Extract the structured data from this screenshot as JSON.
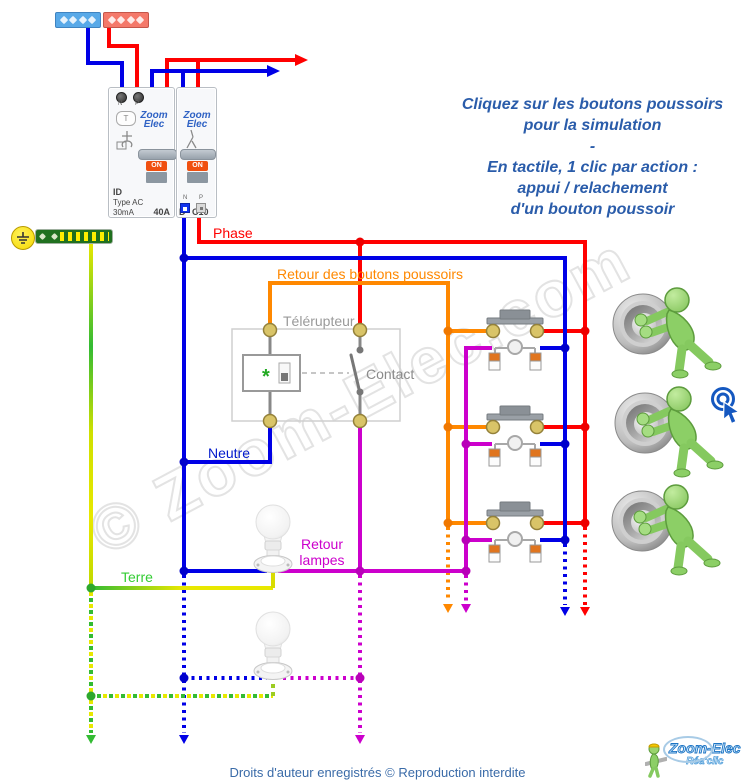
{
  "instructions": {
    "l1": "Cliquez sur les boutons poussoirs",
    "l2": "pour la simulation",
    "l3": "-",
    "l4": "En tactile, 1 clic par action :",
    "l5": "appui / relachement",
    "l6": "d'un bouton poussoir"
  },
  "labels": {
    "phase": "Phase",
    "retour_boutons": "Retour des boutons poussoirs",
    "telerupteur": "Télérupteur",
    "contact": "Contact",
    "neutre": "Neutre",
    "retour_lampes_l1": "Retour",
    "retour_lampes_l2": "lampes",
    "terre": "Terre",
    "coil_mark": "*"
  },
  "modules": {
    "differential": {
      "terminal_n": "N",
      "terminal_p": "P",
      "test_button": "T",
      "brand_l1": "Zoom",
      "brand_l2": "Elec",
      "on_label": "ON",
      "id_label": "ID",
      "type_label": "Type AC",
      "sensitivity": "30mA",
      "rating": "40A"
    },
    "breaker": {
      "brand_l1": "Zoom",
      "brand_l2": "Elec",
      "on_label": "ON",
      "curve": "D",
      "rating": "C10",
      "terminal_n": "N",
      "terminal_p": "P"
    }
  },
  "watermark": {
    "text": "© Zoom-Elec.com"
  },
  "footer": {
    "copyright": "Droits d'auteur enregistrés © Reproduction interdite"
  },
  "logo": {
    "name": "Zoom-Elec",
    "tagline": "Réa'clic"
  },
  "colors": {
    "phase": "#ff0000",
    "neutre": "#0000e6",
    "retour_boutons": "#ff8800",
    "retour_lampes": "#cc00cc",
    "terre_green": "#33cc33",
    "terre_yellow": "#e8e800",
    "instruction_blue": "#2a5caa"
  }
}
